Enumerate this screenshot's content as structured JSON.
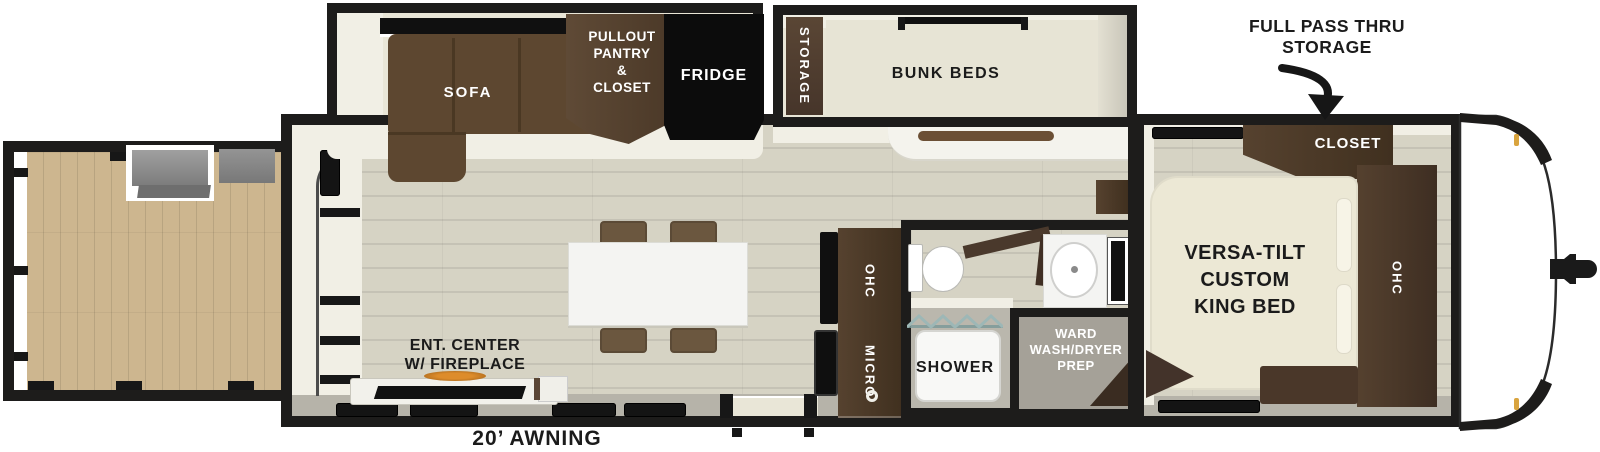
{
  "labels": {
    "sofa": "SOFA",
    "pantry": "PULLOUT\nPANTRY\n&\nCLOSET",
    "fridge": "FRIDGE",
    "storage": "STORAGE",
    "bunks": "BUNK BEDS",
    "passthru": "FULL PASS THRU\nSTORAGE",
    "closet": "CLOSET",
    "bed": "VERSA-TILT\nCUSTOM\nKING BED",
    "ohc_bedroom": "OHC",
    "ohc_kitchen": "OHC",
    "micro": "MICRO",
    "shower": "SHOWER",
    "ward": "WARD\nWASH/DRYER\nPREP",
    "ent_center": "ENT. CENTER\nW/ FIREPLACE",
    "awning": "20’ AWNING"
  },
  "colors": {
    "wall": "#1d1c1b",
    "floor": "#d6d3c4",
    "deck": "#cdb68f",
    "cream": "#e9e6d7",
    "ivory": "#f1efe5",
    "sofa": "#5d4730",
    "chair": "#6b573f",
    "appliance": "#101010",
    "walk": "#b6b3a9",
    "grayroom": "#a5a198",
    "amber": "#d9a43e",
    "flame": "#dd8c2b",
    "glass": "#9db7b6"
  }
}
